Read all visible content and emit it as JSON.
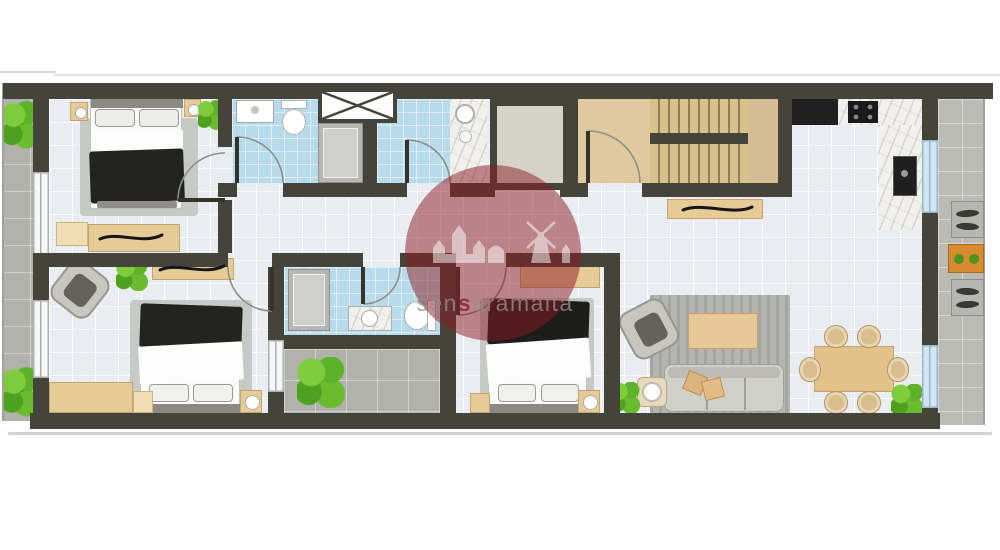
{
  "watermark": {
    "full_text": "sensaramalta",
    "prefix": "sen",
    "highlight": "s",
    "suffix": "aramalta"
  },
  "palette": {
    "wall": "#45443b",
    "floor": "#e9ecf1",
    "bathroom_tile": "#b7dbea",
    "paving": "#b1b2ac",
    "wood": "#dfc497",
    "watermark_circle": "#8b1a21",
    "watermark_text": "#8f8f8f",
    "watermark_highlight": "#7e2330"
  }
}
